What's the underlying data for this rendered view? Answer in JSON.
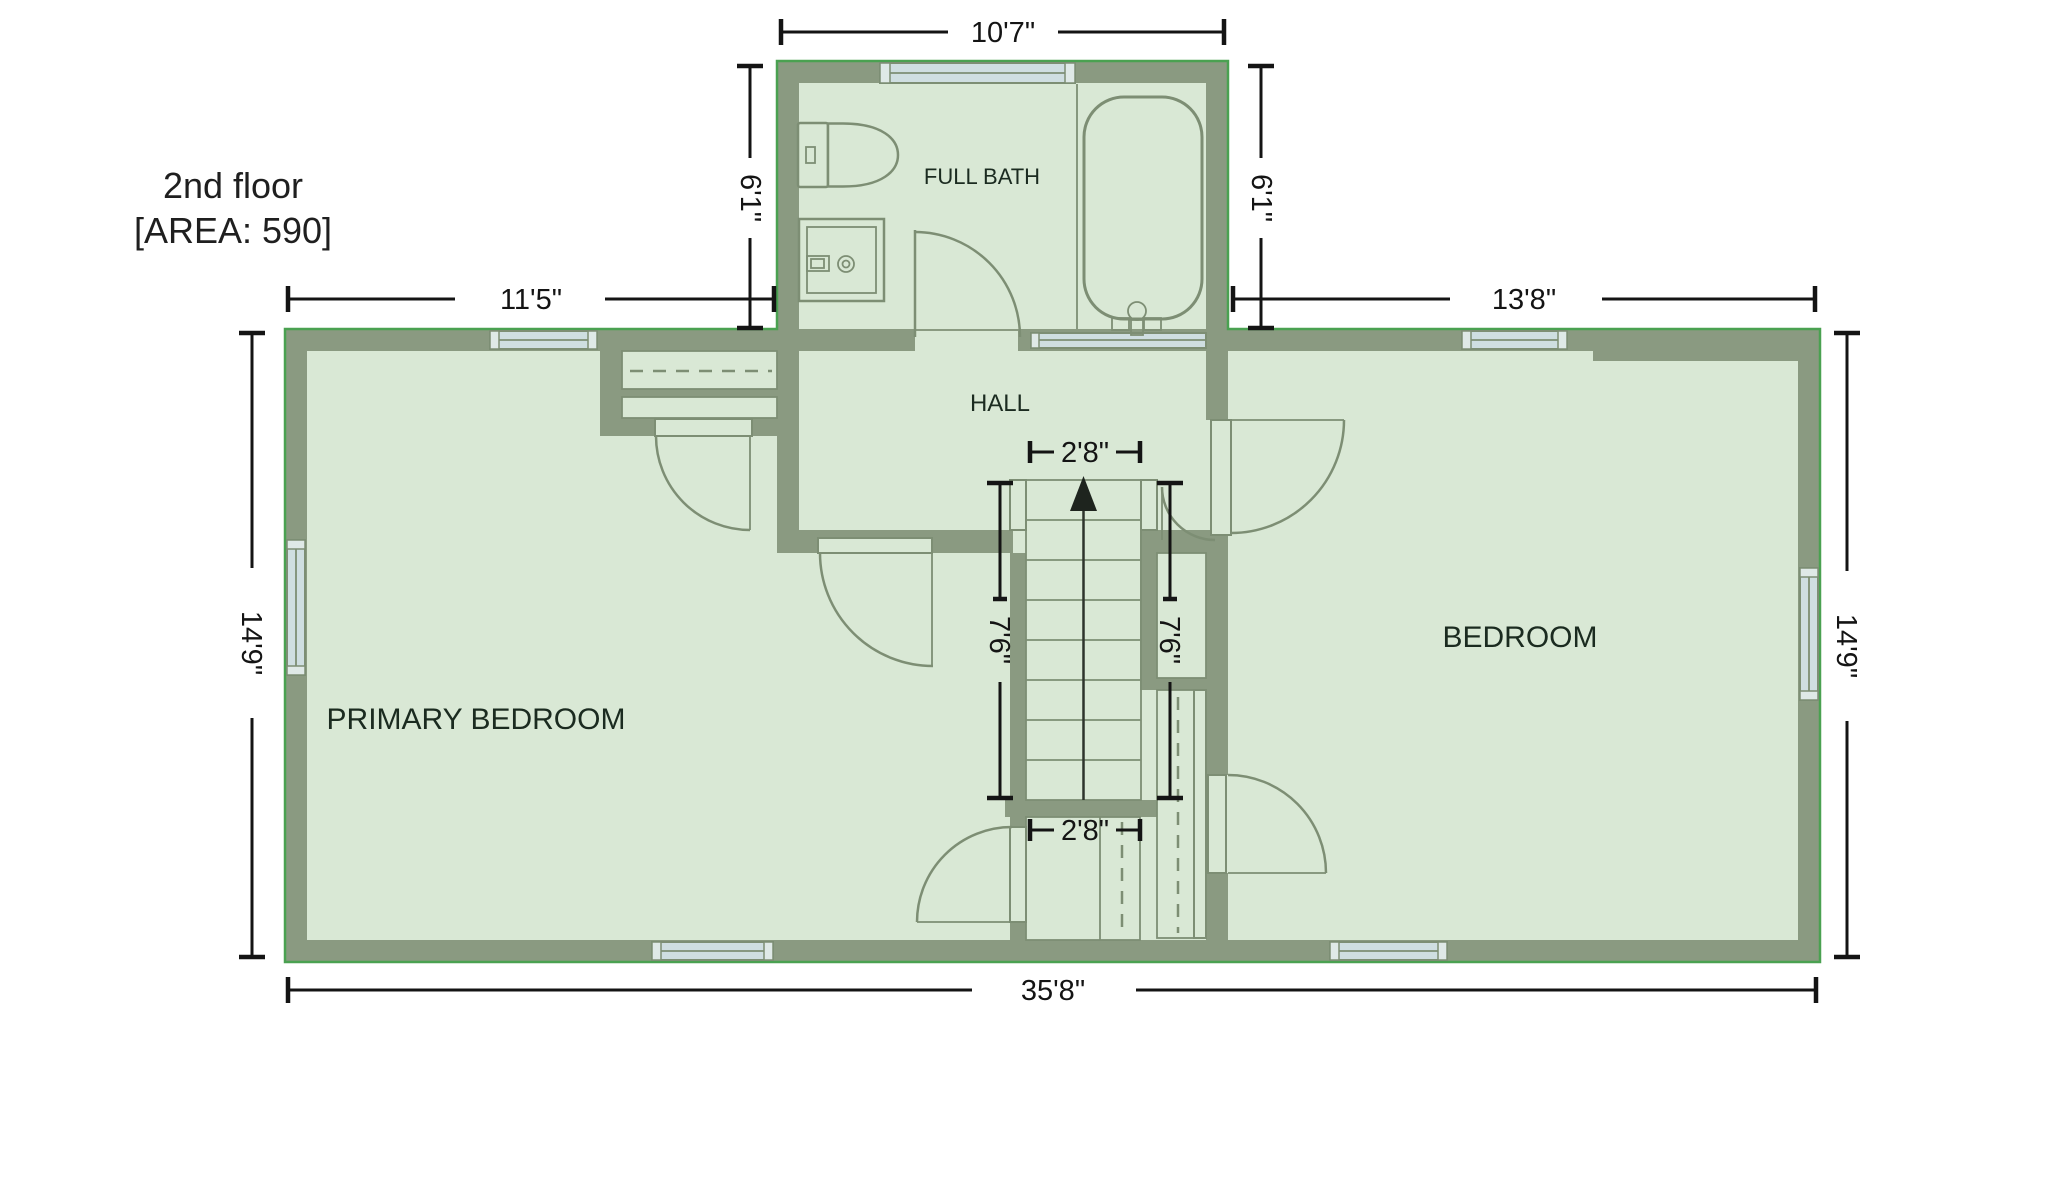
{
  "title": {
    "line1": "2nd floor",
    "line2": "[AREA: 590]"
  },
  "rooms": {
    "full_bath": "FULL BATH",
    "hall": "HALL",
    "primary_bedroom": "PRIMARY BEDROOM",
    "bedroom": "BEDROOM"
  },
  "dimensions": {
    "bath_width": "10'7\"",
    "bath_height_left": "6'1\"",
    "bath_height_right": "6'1\"",
    "upper_left_width": "11'5\"",
    "upper_right_width": "13'8\"",
    "left_height": "14'9\"",
    "right_height": "14'9\"",
    "bottom_width": "35'8\"",
    "stair_width_top": "2'8\"",
    "stair_width_bottom": "2'8\"",
    "stair_run_left": "7'6\"",
    "stair_run_right": "7'6\""
  },
  "colors": {
    "wall": "#8a9a81",
    "floor": "#d9e8d5",
    "fixture_line": "#7d8e74",
    "window": "#cfdee1",
    "outer_outline": "#4aa151",
    "dimension_text": "#141414",
    "room_label": "#1b2b20"
  }
}
